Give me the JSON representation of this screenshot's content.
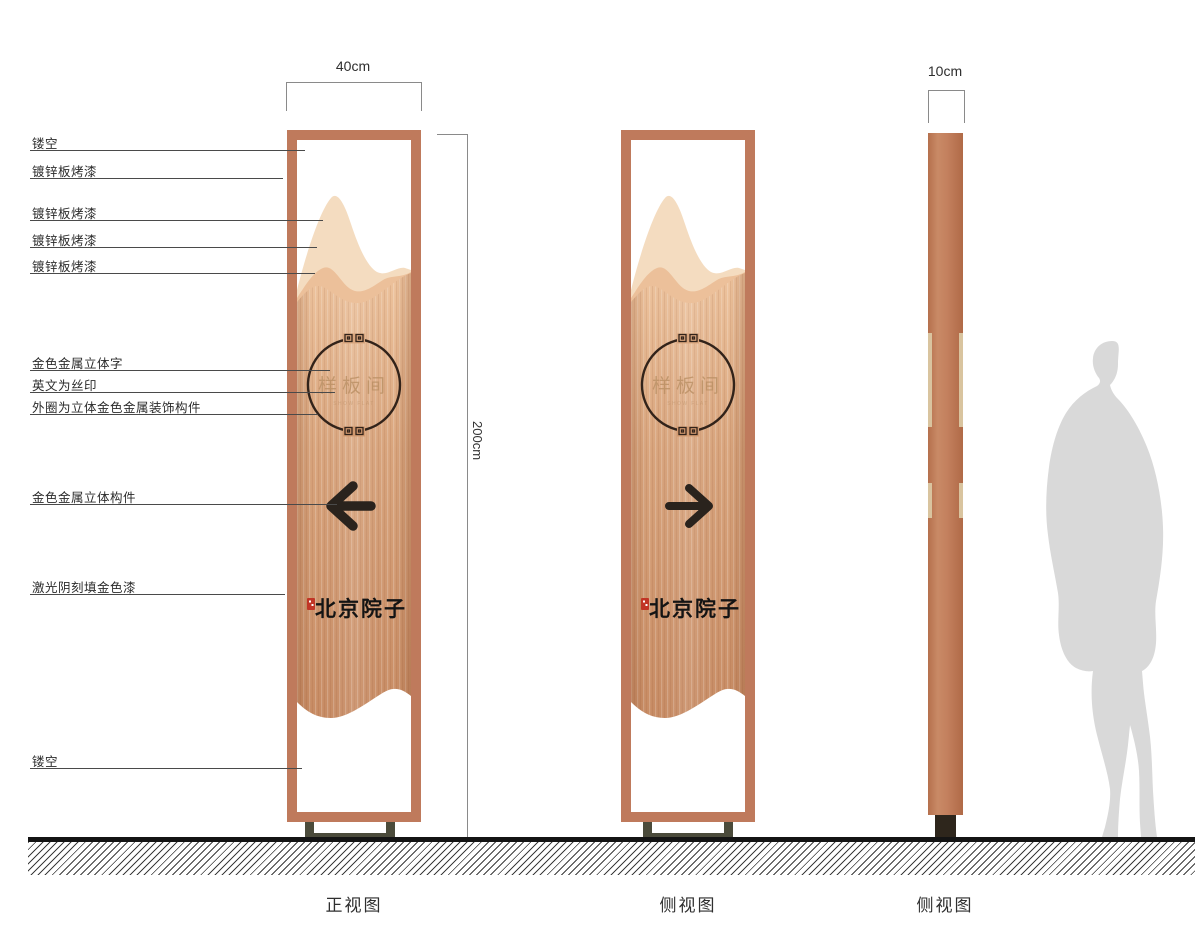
{
  "callouts": [
    {
      "label": "镂空"
    },
    {
      "label": "镀锌板烤漆"
    },
    {
      "label": "镀锌板烤漆"
    },
    {
      "label": "镀锌板烤漆"
    },
    {
      "label": "镀锌板烤漆"
    },
    {
      "label": "金色金属立体字"
    },
    {
      "label": "英文为丝印"
    },
    {
      "label": "外圈为立体金色金属装饰构件"
    },
    {
      "label": "金色金属立体构件"
    },
    {
      "label": "激光阴刻填金色漆"
    },
    {
      "label": "镂空"
    }
  ],
  "dimensions": {
    "front_width": "40cm",
    "side_width": "10cm",
    "height": "200cm"
  },
  "views": {
    "front": "正视图",
    "side": "侧视图",
    "side2": "侧视图"
  },
  "sign": {
    "plate_text": "样板间",
    "english_subtext": "SHOW FLAT",
    "brand_text": "北京院子",
    "front_arrow_icon": "arrow-left",
    "side_arrow_icon": "arrow-right"
  },
  "colors": {
    "frame_copper": "#bf7a5c",
    "panel_top": "#eec49e",
    "panel_bottom": "#c88c64",
    "mountain_back": "#f4dcc0",
    "mountain_mid": "#ecc09a",
    "gold_text": "#b98e63",
    "ring_stroke": "#32231a",
    "arrow_ink": "#2a231d",
    "brand_ink": "#141414",
    "seal_red": "#c13526",
    "base_olive": "#4b4b3b",
    "side_strip": "#d9c49f",
    "silhouette_gray": "#d9d9d9",
    "ground_ink": "#141414"
  }
}
